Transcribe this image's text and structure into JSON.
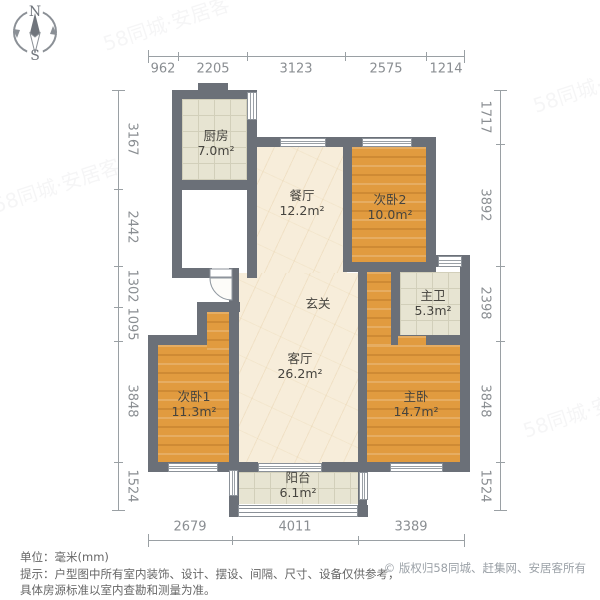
{
  "compass": {
    "north": "N",
    "south": "S"
  },
  "dims": {
    "top": [
      "962",
      "2205",
      "3123",
      "2575",
      "1214"
    ],
    "bottom": [
      "2679",
      "4011",
      "3389"
    ],
    "left": [
      "3167",
      "2442",
      "1302",
      "1095",
      "3848",
      "1524"
    ],
    "right": [
      "1717",
      "3892",
      "2398",
      "3848",
      "1524"
    ]
  },
  "rooms": {
    "kitchen": {
      "name": "厨房",
      "area": "7.0m²"
    },
    "dining": {
      "name": "餐厅",
      "area": "12.2m²"
    },
    "bedroom2": {
      "name": "次卧2",
      "area": "10.0m²"
    },
    "master_bath": {
      "name": "主卫",
      "area": "5.3m²"
    },
    "hallway": {
      "name": "玄关"
    },
    "living": {
      "name": "客厅",
      "area": "26.2m²"
    },
    "bedroom1": {
      "name": "次卧1",
      "area": "11.3m²"
    },
    "master_bedroom": {
      "name": "主卧",
      "area": "14.7m²"
    },
    "balcony": {
      "name": "阳台",
      "area": "6.1m²"
    }
  },
  "footer": {
    "unit": "单位：毫米(mm)",
    "tip_line1": "提示：户型图中所有室内装饰、设计、摆设、间隔、尺寸、设备仅供参考，",
    "tip_line2": "具体房源标准以室内查勘和测量为准。",
    "copyright": "© 版权归58同城、赶集网、安居客所有"
  },
  "watermark": "58同城·安居客",
  "colors": {
    "wall": "#6b7078",
    "wood_floor": "#e19b3f",
    "tile_floor": "#e7e4d2",
    "marble_floor": "#f7edda",
    "dim_text": "#8a8e92"
  }
}
